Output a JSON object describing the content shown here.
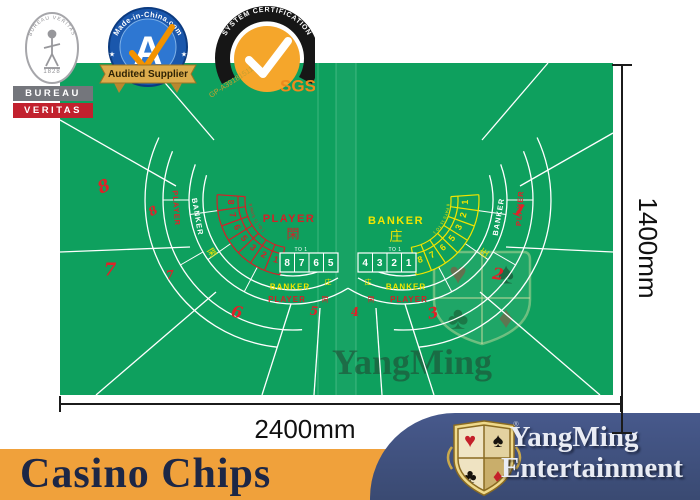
{
  "certs": {
    "bureau_veritas": {
      "oval_text": "BUREAU VERITAS",
      "year": "1828",
      "bar1": "BUREAU",
      "bar2": "VERITAS"
    },
    "made_in_china": {
      "ring_text": "Made-in-China.com",
      "letter": "A",
      "banner": "Audited Supplier",
      "star": "★"
    },
    "sgs": {
      "arch_text": "SYSTEM CERTIFICATION",
      "cert_no": "GP-A39181511",
      "brand": "SGS"
    }
  },
  "table": {
    "felt_color": "#0EA05E",
    "accent_red": "#D42027",
    "accent_yellow": "#F2E500",
    "watermark_text": "YangMing",
    "watermark_suits": {
      "heart": "♥",
      "spade": "♠",
      "club": "♣",
      "diamond": "♦"
    },
    "labels": {
      "player": "PLAYER",
      "banker": "BANKER",
      "player_cn": "閑",
      "banker_cn": "庄",
      "to_1": "TO 1",
      "fine_print": "8 PAYS 11 TO 1"
    },
    "left": {
      "seats": [
        "8",
        "7",
        "6",
        "5"
      ],
      "arc_numbers": [
        "8",
        "7",
        "6",
        "5",
        "3",
        "2",
        "1"
      ],
      "row_numbers": [
        "8",
        "7",
        "6",
        "5"
      ]
    },
    "right": {
      "seats": [
        "1",
        "2",
        "3",
        "4"
      ],
      "arc_numbers": [
        "1",
        "2",
        "3",
        "5",
        "6",
        "7",
        "8"
      ],
      "row_numbers": [
        "4",
        "3",
        "2",
        "1"
      ]
    }
  },
  "dimensions": {
    "width_label": "2400mm",
    "height_label": "1400mm"
  },
  "footer": {
    "product_text": "Casino Chips",
    "brand_line1": "YangMing",
    "brand_line2": "Entertainment",
    "registered": "®",
    "suits": {
      "heart": "♥",
      "spade": "♠",
      "club": "♣",
      "diamond": "♦"
    }
  }
}
